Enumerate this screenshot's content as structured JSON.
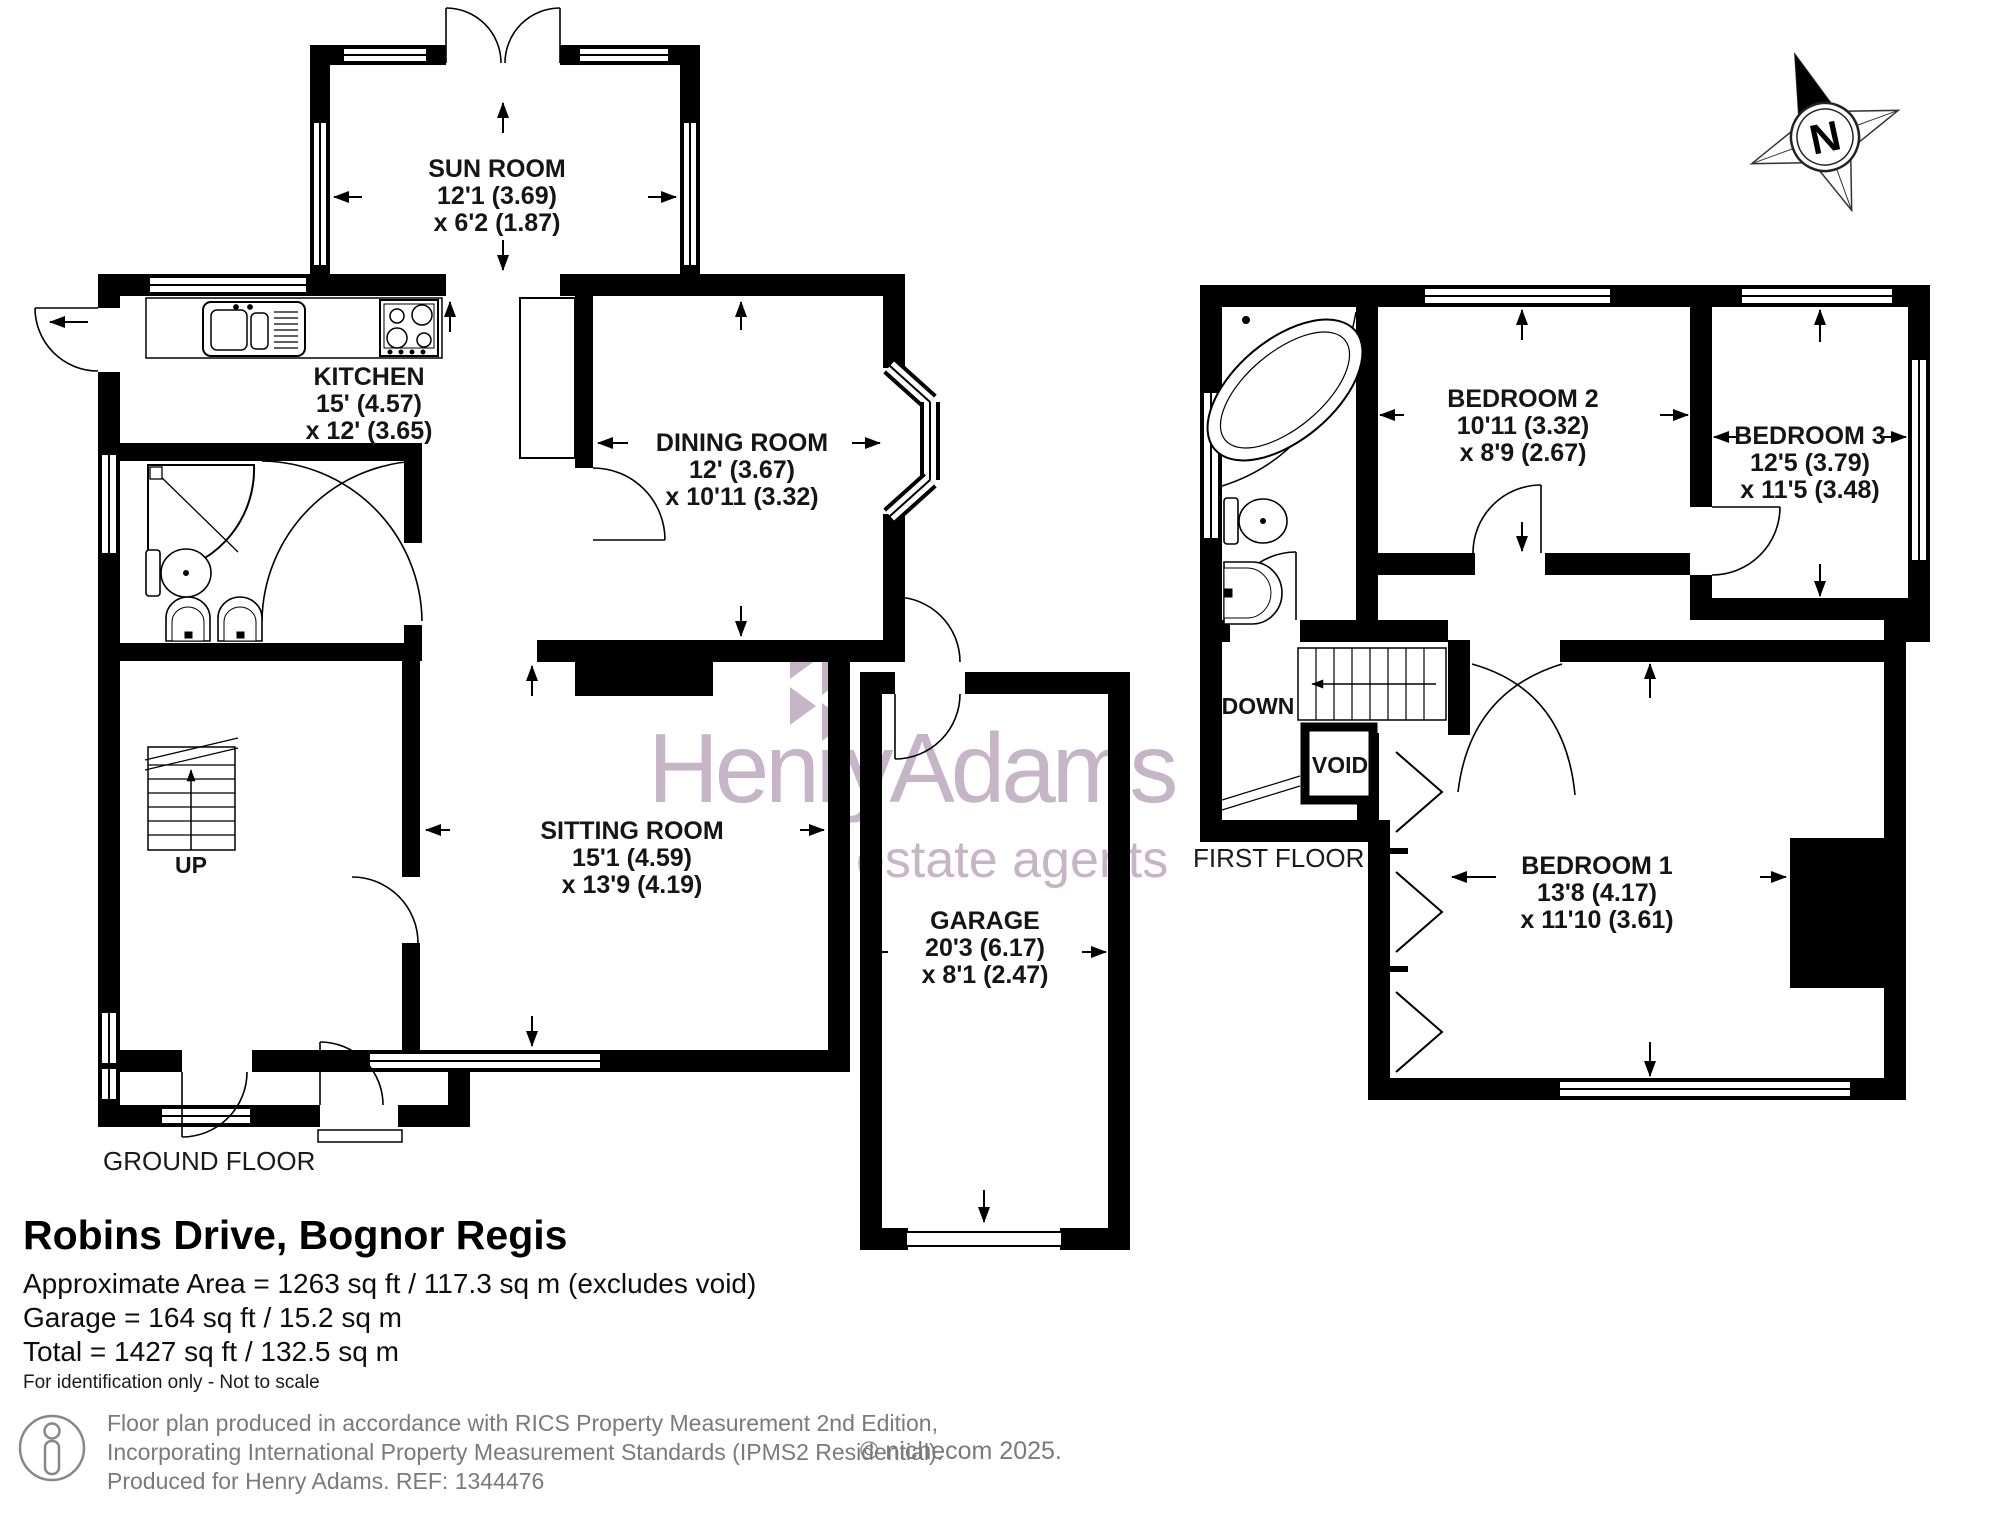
{
  "compass": {
    "n": "N"
  },
  "watermark": {
    "brand": "HenryAdams",
    "tagline": "estate agents",
    "color": "#c6b5c6"
  },
  "ground_floor": {
    "label": "GROUND FLOOR",
    "stairs_label": "UP",
    "rooms": [
      {
        "name": "SUN ROOM",
        "dim1": "12'1 (3.69)",
        "dim2": "x 6'2 (1.87)"
      },
      {
        "name": "KITCHEN",
        "dim1": "15' (4.57)",
        "dim2": "x 12' (3.65)"
      },
      {
        "name": "DINING ROOM",
        "dim1": "12' (3.67)",
        "dim2": "x 10'11 (3.32)"
      },
      {
        "name": "SITTING ROOM",
        "dim1": "15'1 (4.59)",
        "dim2": "x 13'9 (4.19)"
      },
      {
        "name": "GARAGE",
        "dim1": "20'3 (6.17)",
        "dim2": "x 8'1 (2.47)"
      }
    ]
  },
  "first_floor": {
    "label": "FIRST FLOOR",
    "stairs_label": "DOWN",
    "void_label": "VOID",
    "rooms": [
      {
        "name": "BEDROOM 2",
        "dim1": "10'11 (3.32)",
        "dim2": "x 8'9 (2.67)"
      },
      {
        "name": "BEDROOM 3",
        "dim1": "12'5 (3.79)",
        "dim2": "x 11'5 (3.48)"
      },
      {
        "name": "BEDROOM 1",
        "dim1": "13'8 (4.17)",
        "dim2": "x 11'10 (3.61)"
      }
    ]
  },
  "title_block": {
    "title": "Robins Drive, Bognor Regis",
    "area_line": "Approximate Area = 1263 sq ft / 117.3 sq m (excludes void)",
    "garage_line": "Garage = 164 sq ft / 15.2 sq m",
    "total_line": "Total = 1427 sq ft / 132.5 sq m",
    "disclaimer": "For identification only - Not to scale"
  },
  "footer": {
    "line1": "Floor plan produced in accordance with RICS Property Measurement 2nd Edition,",
    "line2": "Incorporating International Property Measurement Standards (IPMS2 Residential).",
    "line3": "Produced for Henry Adams.   REF: 1344476",
    "copyright": "© nichecom 2025."
  }
}
